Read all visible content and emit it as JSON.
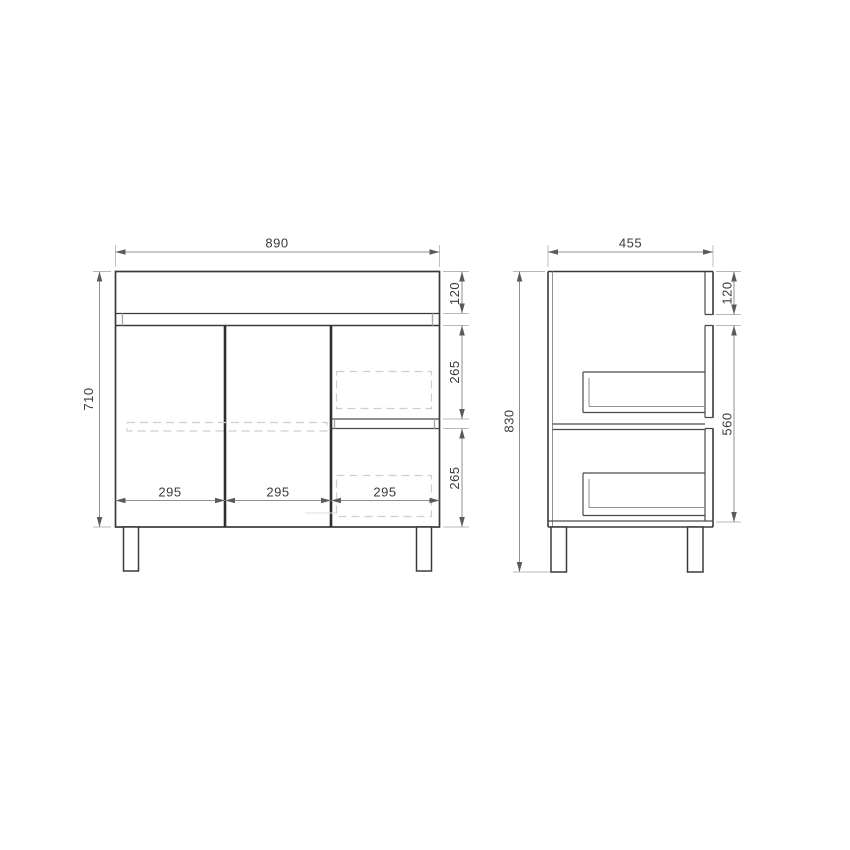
{
  "front_view": {
    "width": "890",
    "height": "710",
    "top_panel_height": "120",
    "upper_drawer_height": "265",
    "lower_drawer_height": "265",
    "section_widths": [
      "295",
      "295",
      "295"
    ]
  },
  "side_view": {
    "depth": "455",
    "overall_height": "830",
    "top_panel_height": "120",
    "lower_body_height": "560"
  },
  "colors": {
    "line": "#3a3a3a",
    "dimension_line": "#8f8f8f",
    "dashed_detail": "#cecece",
    "label_text": "#3b3b3b",
    "background": "#ffffff"
  }
}
